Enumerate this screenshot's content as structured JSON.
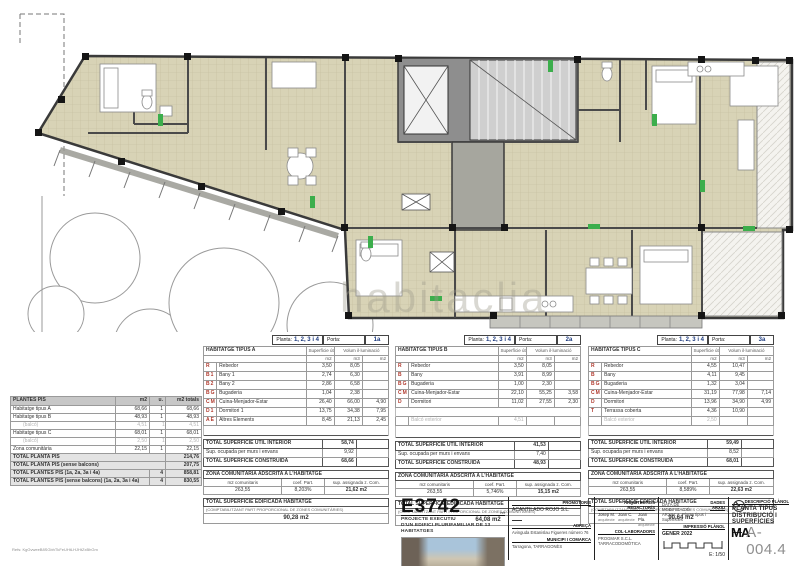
{
  "watermark": "habitaclia",
  "file_ref": "Refs: KgGvweeB8SGbhTkFeUHtLHJHtZxBhGm",
  "plantes_pis": {
    "title": "PLANTES PIS",
    "col_m2": "m2",
    "col_u": "u.",
    "col_tot": "m2 totals",
    "rows": [
      {
        "n": "Habitatge tipus A",
        "m2": "68,66",
        "u": "1",
        "t": "68,66"
      },
      {
        "n": "Habitatge tipus B",
        "m2": "48,93",
        "u": "1",
        "t": "48,93"
      },
      {
        "n": "(balcó)",
        "m2": "4,51",
        "u": "1",
        "t": "4,51"
      },
      {
        "n": "Habitatge tipus C",
        "m2": "68,01",
        "u": "1",
        "t": "68,01"
      },
      {
        "n": "(balcó)",
        "m2": "2,50",
        "u": "1",
        "t": "2,50"
      },
      {
        "n": "Zona comunitària",
        "m2": "22,15",
        "u": "1",
        "t": "22,15"
      }
    ],
    "totals": [
      {
        "n": "TOTAL PLANTA PIS",
        "u": "",
        "t": "214,76"
      },
      {
        "n": "TOTAL PLANTA PIS (sense balcons)",
        "u": "",
        "t": "207,75"
      },
      {
        "n": "TOTAL PLANTES PIS (1a, 2a, 3a i 4a)",
        "u": "4",
        "t": "858,81"
      },
      {
        "n": "TOTAL PLANTES PIS (sense balcons) (1a, 2a, 3a i 4a)",
        "u": "4",
        "t": "830,55"
      }
    ]
  },
  "ut": {
    "planta_label": "Planta:",
    "planta_value": "1, 2, 3 i 4",
    "porta_label": "Porta:",
    "col_util": "Superfície útil",
    "col_volum": "Volum il·luminació",
    "m2": "m2",
    "m3": "m3",
    "m2b": "m2",
    "total_util": "TOTAL SUPERFÍCIE ÚTIL INTERIOR",
    "murs": "Sup. ocupada per murs i envans",
    "total_constr": "TOTAL SUPERFÍCIE CONSTRUÏDA",
    "zona_title": "ZONA COMUNITÀRIA ADSCRITA A L'HABITATGE",
    "zona_c1": "m2 comunitaris",
    "zona_c2": "coef. Part.",
    "zona_c3": "sup. assignada z. Com.",
    "edif_title": "TOTAL SUPERFÍCIE EDIFICADA HABITATGE",
    "edif_note": "(COMPTABILITZANT PART PROPORCIONAL DE ZONES COMUNITÀRIES)"
  },
  "tables": {
    "a": {
      "name": "HABITATGE TIPUS A",
      "porta": "1a",
      "rows": [
        {
          "c": "R",
          "n": "Rebedor",
          "u": "3,50",
          "v": "8,05",
          "i": ""
        },
        {
          "c": "B1",
          "n": "Bany 1",
          "u": "2,74",
          "v": "6,30",
          "i": ""
        },
        {
          "c": "B2",
          "n": "Bany 2",
          "u": "2,86",
          "v": "6,58",
          "i": ""
        },
        {
          "c": "BG",
          "n": "Bugaderia",
          "u": "1,04",
          "v": "2,38",
          "i": ""
        },
        {
          "c": "CMR",
          "n": "Cuina-Menjador-Estar",
          "u": "26,40",
          "v": "66,00",
          "i": "4,90"
        },
        {
          "c": "D1",
          "n": "Dormitori 1",
          "u": "13,75",
          "v": "34,38",
          "i": "7,95"
        },
        {
          "c": "AE",
          "n": "Altres Elements",
          "u": "8,45",
          "v": "21,13",
          "i": "2,45"
        }
      ],
      "total_util": "58,74",
      "murs": "9,92",
      "constr": "68,66",
      "zona_m2": "263,55",
      "zona_coef": "8,203%",
      "zona_sup": "21,62 m2",
      "edificada": "90,28 m2"
    },
    "b": {
      "name": "HABITATGE TIPUS B",
      "porta": "2a",
      "rows": [
        {
          "c": "R",
          "n": "Rebedor",
          "u": "3,50",
          "v": "8,05",
          "i": ""
        },
        {
          "c": "B",
          "n": "Bany",
          "u": "3,91",
          "v": "8,99",
          "i": ""
        },
        {
          "c": "BG",
          "n": "Bugaderia",
          "u": "1,00",
          "v": "2,30",
          "i": ""
        },
        {
          "c": "CMR",
          "n": "Cuina-Menjador-Estar",
          "u": "22,10",
          "v": "55,25",
          "i": "3,58"
        },
        {
          "c": "D",
          "n": "Dormitori",
          "u": "11,02",
          "v": "27,55",
          "i": "2,30"
        }
      ],
      "balco_label": "Balcó exterior",
      "balco": "4,51",
      "total_util": "41,53",
      "murs": "7,40",
      "constr": "48,93",
      "zona_m2": "263,55",
      "zona_coef": "5,746%",
      "zona_sup": "15,15 m2",
      "edificada": "64,08 m2"
    },
    "c": {
      "name": "HABITATGE TIPUS C",
      "porta": "3a",
      "rows": [
        {
          "c": "R",
          "n": "Rebedor",
          "u": "4,55",
          "v": "10,47",
          "i": ""
        },
        {
          "c": "B",
          "n": "Bany",
          "u": "4,11",
          "v": "9,45",
          "i": ""
        },
        {
          "c": "BG",
          "n": "Bugaderia",
          "u": "1,32",
          "v": "3,04",
          "i": ""
        },
        {
          "c": "CMR",
          "n": "Cuina-Menjador-Estar",
          "u": "31,19",
          "v": "77,98",
          "i": "7,14"
        },
        {
          "c": "D",
          "n": "Dormitori",
          "u": "13,96",
          "v": "34,90",
          "i": "4,99"
        },
        {
          "c": "T",
          "n": "Terrassa coberta",
          "u": "4,36",
          "v": "10,90",
          "i": ""
        }
      ],
      "balco_label": "Balcó exterior",
      "balco": "2,50",
      "total_util": "59,49",
      "murs": "8,52",
      "constr": "68,01",
      "zona_m2": "263,55",
      "zona_coef": "8,589%",
      "zona_sup": "22,63 m2",
      "edificada": "90,64 m2"
    }
  },
  "titleblock": {
    "code": "E3742",
    "code_suffix": "ref",
    "project_line1": "PROJECTE EXECUTIU",
    "project_line2": "D'UN EDIFICI PLURIFAMILIAR DE 13",
    "project_line3": "HABITATGES",
    "promotor_label": "PROMOTOR/S",
    "promotor": "ACANTILADO ROJO S.L.",
    "adreca_label": "ADREÇA",
    "adreca": "Avinguda Estanislau Figueres número 76",
    "municipi_label": "MUNICIPI I COMARCA",
    "municipi": "Tarragona, TARRAGONÈS",
    "arquitectes_label": "ARQUITECTE/S REDACTOR/S",
    "arq1": "Josep M.",
    "arq1_role": "arquitecte",
    "arq2": "Joan C.",
    "arq2_role": "arquitecte",
    "arq3": "Joan Pla.",
    "arq3_role": "arquitecte",
    "collab_label": "COL·LABORADORS",
    "collab": "PROGMAR S.C.L.",
    "collab2": "TARRACODOMÒTICA",
    "modif_label": "DATA DE MODIFICACIÓ",
    "dades_label": "DADES ARXIU",
    "arxiu_line": "ARXIU: A. Planta tipus i Superfícies",
    "impressio_label": "IMPRESSIÓ PLÀNOL",
    "impressio": "GENER 2022",
    "escala": "E: 1/50",
    "descripcio_label": "DESCRIPCIÓ PLÀNOL",
    "descripcio1": "PLANTA TIPUS",
    "descripcio2": "DISTRIBUCIÓ I SUPERFÍCIES",
    "logo": "MA",
    "sheet": "A-004.4"
  },
  "colors": {
    "floor_beige": "#d8d3b6",
    "wall_gray": "#3a3a3a",
    "core_gray": "#8e8e8e",
    "green_accent": "#3cae4c",
    "red_code": "#b03a2e",
    "navy": "#1d3a7e",
    "sheet_gray": "#8f8f8f"
  }
}
